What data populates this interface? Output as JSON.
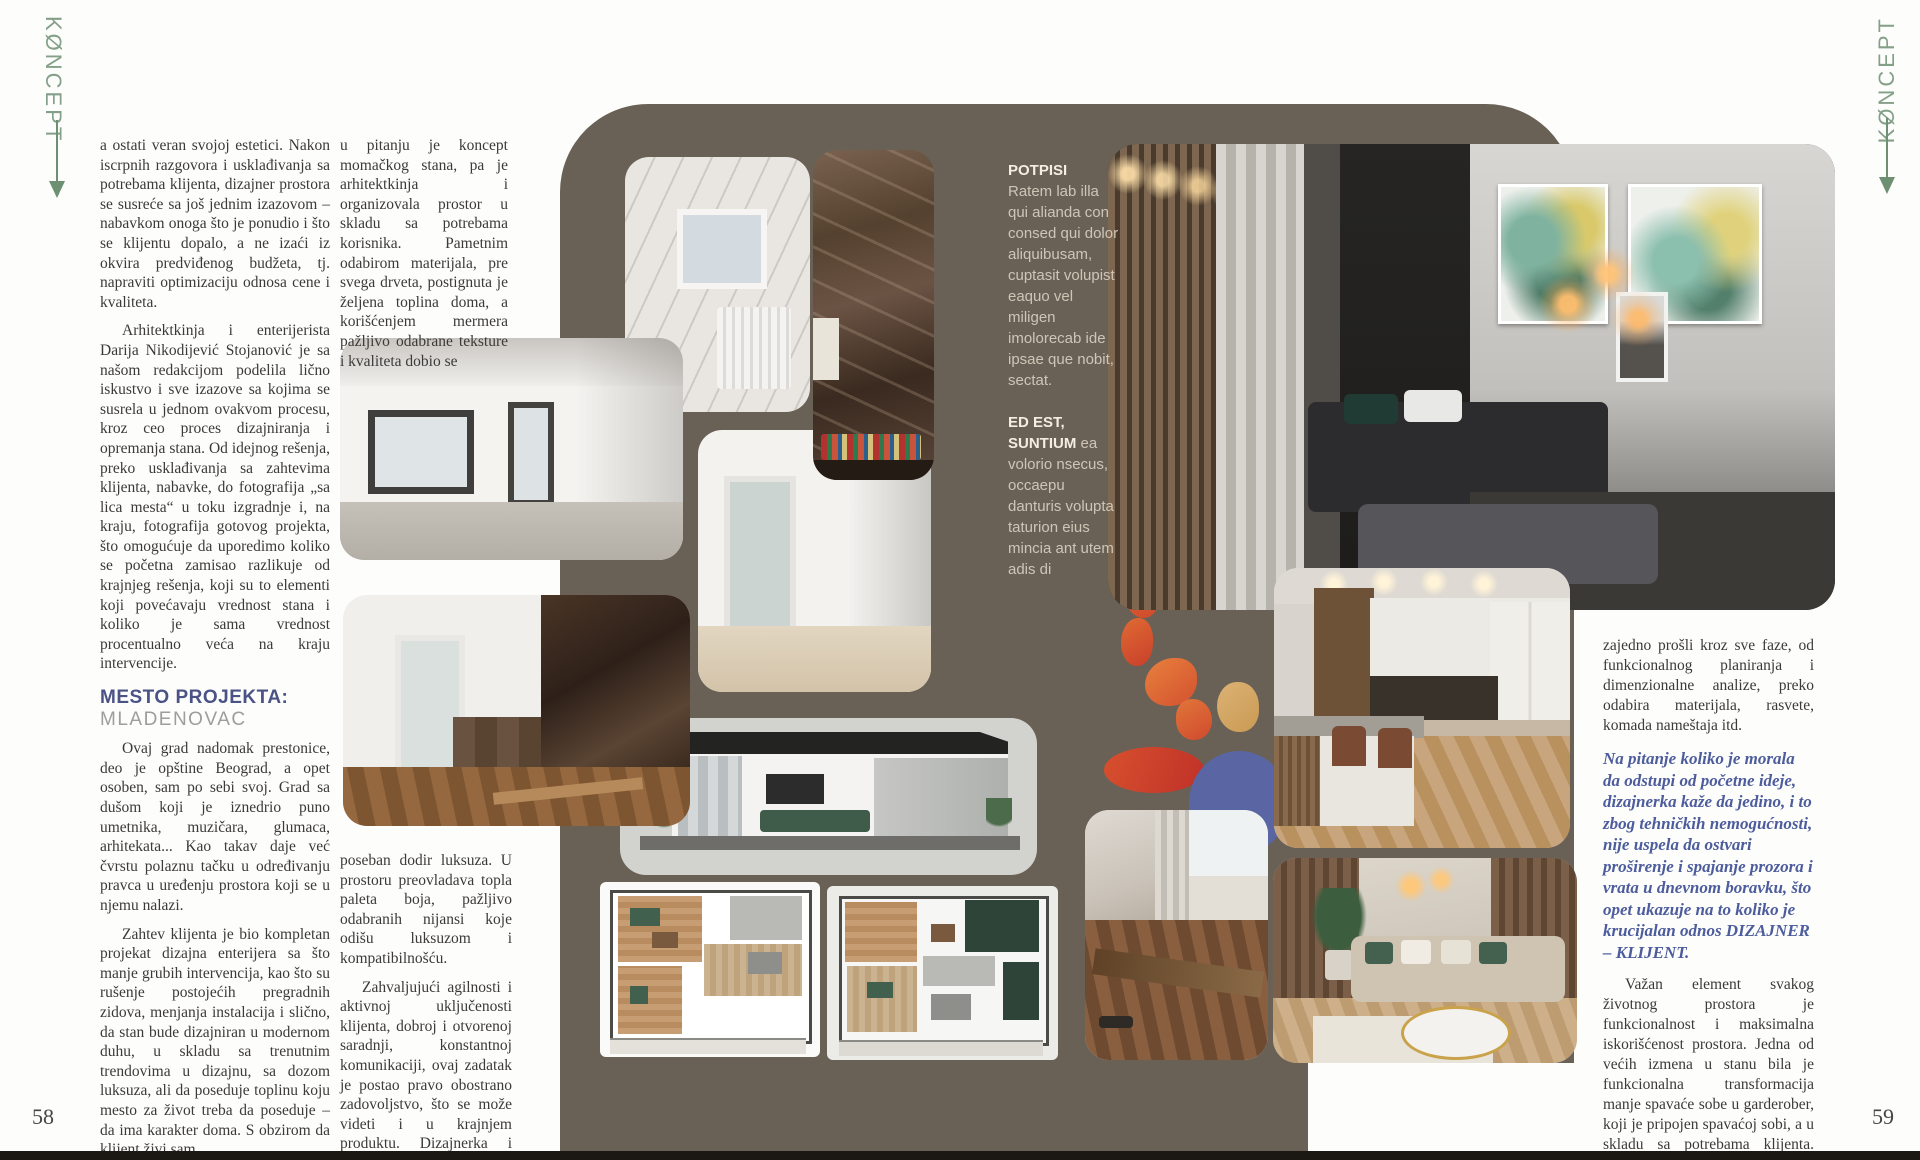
{
  "magazine": {
    "logo": "KØNCEPT"
  },
  "page_left": {
    "page_number": "58",
    "col1_para1": "a ostati veran svojoj estetici. Nakon iscrpnih razgovora i usklađivanja sa potrebama klijenta, dizajner prostora se susreće sa još jednim izazovom – nabavkom onoga što je ponudio i što se klijentu dopalo, a ne izaći iz okvira predviđenog budžeta, tj. napraviti optimizaciju odnosa cene i kvaliteta.",
    "col1_para2": "Arhitektkinja i enterijerista Darija Nikodijević Stojanović je sa našom redakcijom podelila lično iskustvo i sve izazove sa kojima se susrela u jednom ovakvom procesu, kroz ceo proces dizajniranja i opremanja stana. Od idejnog rešenja, preko usklađivanja sa zahtevima klijenta, nabavke, do fotografija „sa lica mesta“ u toku izgradnje i, na kraju, fotografija gotovog projekta, što omogućuje da uporedimo koliko se početna zamisao razlikuje od krajnjeg rešenja, koji su to elementi koji povećavaju vrednost stana i koliko je sama vrednost procentualno veća na kraju intervencije.",
    "location_label": "MESTO PROJEKTA:",
    "location_value": "MLADENOVAC",
    "col1_para3": "Ovaj grad nadomak prestonice, deo je opštine Beograd, a opet osoben, sam po sebi svoj. Grad sa dušom koji je iznedrio puno umetnika, muzičara, glumaca, arhitekata... Kao takav daje već čvrstu polaznu tačku u određivanju pravca u uređenju prostora koji se u njemu nalazi.",
    "col1_para4": "Zahtev klijenta je bio kompletan projekat dizajna enterijera sa što manje grubih intervencija, kao što su rušenje postojećih pregradnih zidova, menjanja instalacija i slično, da stan bude dizajniran u modernom duhu, u skladu sa trenutnim trendovima u dizajnu, sa dozom luksuza, ali da poseduje toplinu koju mesto za život treba da poseduje – da ima karakter doma. S obzirom da klijent živi sam,",
    "col2_para1": "u pitanju je koncept momačkog stana, pa je arhitektkinja i organizovala prostor u skladu sa potrebama korisnika. Pametnim odabirom materijala, pre svega drveta, postignuta je željena toplina doma, a korišćenjem mermera pažljivo odabrane teksture i kvaliteta dobio se",
    "col2_para2": "poseban dodir luksuza. U prostoru preovladava topla paleta boja, pažljivo odabranih nijansi koje odišu luksuzom i kompatibilnošću.",
    "col2_para3": "Zahvaljujući agilnosti i aktivnoj uključenosti klijenta, dobroj i otvorenoj saradnji, konstantnoj komunikaciji, ovaj zadatak je postao pravo obostrano zadovoljstvo, što se može videti i u krajnjem produktu.  Dizajnerka i klijent su"
  },
  "captions": {
    "title1": "POTPISI",
    "body1": "Ratem lab illa qui alianda con consed qui dolor aliquibusam, cuptasit volupist eaquo vel miligen imolorecab ide ipsae que nobit, sectat.",
    "title2": "ED EST, SUNTIUM",
    "body2": "ea volorio nsecus, occaepu danturis volupta taturion eius mincia ant utem adis di"
  },
  "page_right": {
    "page_number": "59",
    "para1": "zajedno prošli kroz sve faze, od funkcionalnog planiranja i dimenzionalne analize, preko odabira materijala, rasvete, komada nameštaja itd.",
    "quote": "Na pitanje koliko je morala da odstupi od početne ideje, dizajnerka kaže da jedino, i to zbog tehničkih nemogućnosti, nije uspela da ostvari proširenje i spajanje prozora i vrata u dnevnom boravku, što opet ukazuje na to koliko je krucijalan odnos DIZAJNER – KLIJENT.",
    "para2": "Važan element svakog životnog prostora je funkcionalnost i maksimalna iskorišćenost prostora. Jedna od većih izmena u stanu bila je funkcionalna transformacija manje spavaće sobe u garderober, koji je pripojen spavaćoj sobi, a u skladu sa potrebama klijenta. Ovim je spavaća"
  },
  "colors": {
    "canvas_brown": "#6a6156",
    "logo_green": "#84a088",
    "heading_blue": "#4b5286",
    "quote_blue": "#4c5c9c",
    "blob_orange": "#e07035",
    "blob_red": "#c93f2b",
    "blob_blue": "#5a66a3",
    "blob_tan": "#dcb274"
  }
}
